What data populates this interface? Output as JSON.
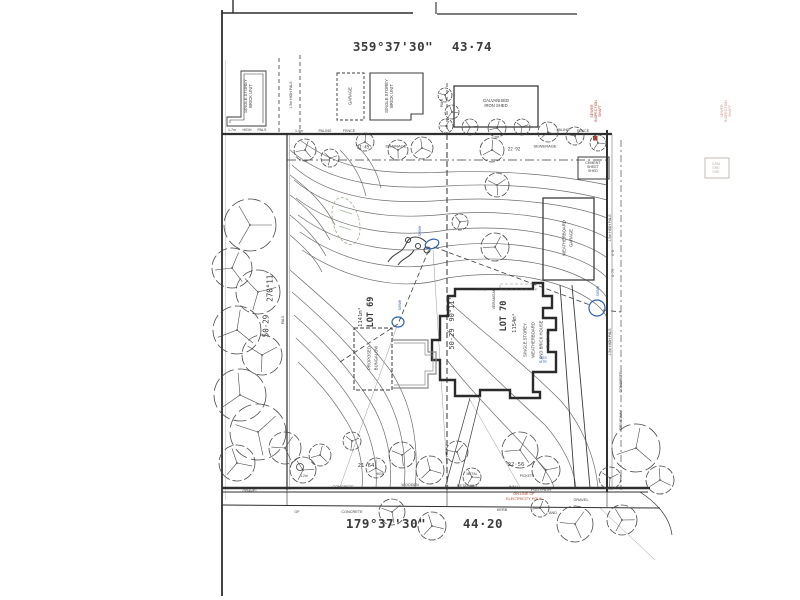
{
  "colors": {
    "ink": "#3b3b3b",
    "line": "#2f2f2f",
    "light": "#8a8a8a",
    "red": "#b2442e",
    "blue": "#2f62ae",
    "green": "#8aa87a",
    "fade": "#b9aca4",
    "fadeRed": "#d09a8c"
  },
  "summary": {
    "plan_type": "site survey plan",
    "lots": [
      {
        "label": "LOT 69",
        "area": "1141m²"
      },
      {
        "label": "LOT 70",
        "area": "1154m²"
      }
    ],
    "boundaries": {
      "north": {
        "bearing": "359°37'30\"",
        "distance": "43·74"
      },
      "south": {
        "bearing": "179°37'30\"",
        "distance": "44·20"
      },
      "west": {
        "bearing": "270°11'",
        "distance": "50·29"
      },
      "middle": {
        "bearing": "90°11'",
        "distance": "50·29"
      }
    },
    "street_strip": [
      "GRAVEL",
      "CONCRETE",
      "WOODEN",
      "RETAINING",
      "WALL",
      "FOOTPATH",
      "OF",
      "CONCRETE",
      "KERB",
      "AND",
      "GRAVEL"
    ]
  },
  "annotations": [
    {
      "name": "bearing-top",
      "text": "359°37'30\"",
      "x": 393,
      "y": 47,
      "rot": 0,
      "fs": 12.5,
      "mono": true,
      "bold": true,
      "ls": 0.5
    },
    {
      "name": "distance-top",
      "text": "43·74",
      "x": 472,
      "y": 47,
      "rot": 0,
      "fs": 12.5,
      "mono": true,
      "bold": true,
      "ls": 0.5
    },
    {
      "name": "bearing-bottom",
      "text": "179°37'30\"",
      "x": 386,
      "y": 524,
      "rot": 0,
      "fs": 12.5,
      "mono": true,
      "bold": true,
      "ls": 0.5
    },
    {
      "name": "distance-bottom",
      "text": "44·20",
      "x": 483,
      "y": 524,
      "rot": 0,
      "fs": 12.5,
      "mono": true,
      "bold": true,
      "ls": 0.5
    },
    {
      "name": "bearing-west",
      "text": "270°11'",
      "x": 271,
      "y": 286,
      "rot": -90,
      "fs": 7.5,
      "mono": true
    },
    {
      "name": "distance-west",
      "text": "50·29",
      "x": 267,
      "y": 326,
      "rot": -90,
      "fs": 7.5,
      "mono": true
    },
    {
      "name": "bearing-middle",
      "text": "90°11'",
      "x": 452,
      "y": 309,
      "rot": -90,
      "fs": 7,
      "mono": true
    },
    {
      "name": "distance-middle",
      "text": "50·29",
      "x": 452,
      "y": 339,
      "rot": -90,
      "fs": 7,
      "mono": true
    },
    {
      "name": "lot-69-label",
      "text": "LOT 69",
      "x": 372,
      "y": 312,
      "rot": -90,
      "fs": 8.5,
      "mono": true,
      "bold": true
    },
    {
      "name": "lot-69-area",
      "text": "1141m²",
      "x": 361,
      "y": 317,
      "rot": -90,
      "fs": 5.5,
      "mono": true
    },
    {
      "name": "lot-70-label",
      "text": "LOT 70",
      "x": 505,
      "y": 316,
      "rot": -90,
      "fs": 8.5,
      "mono": true,
      "bold": true
    },
    {
      "name": "lot-70-area",
      "text": "1154m²",
      "x": 515,
      "y": 323,
      "rot": -90,
      "fs": 5.5,
      "mono": true
    },
    {
      "name": "neighbour-unit-left",
      "text": "SINGLE STOREY\nBRICK UNIT",
      "x": 249,
      "y": 96,
      "rot": -90,
      "fs": 4.2
    },
    {
      "name": "neighbour-garage",
      "text": "GARAGE",
      "x": 351,
      "y": 96,
      "rot": -90,
      "fs": 4.2
    },
    {
      "name": "neighbour-unit-mid",
      "text": "SINGLE STOREY\nBRICK UNIT",
      "x": 390,
      "y": 96,
      "rot": -90,
      "fs": 4.2
    },
    {
      "name": "galvanised-iron-shed",
      "text": "GALVANISED\nIRON SHED",
      "x": 496,
      "y": 104,
      "rot": 0,
      "fs": 4.2
    },
    {
      "name": "cement-sheet-shed",
      "text": "CEMENT\nSHEET\nSHED",
      "x": 593,
      "y": 167,
      "rot": 0,
      "fs": 3.6
    },
    {
      "name": "cement-shed-ghost",
      "text": "CEM\nSHE\nSHE",
      "x": 716,
      "y": 168,
      "rot": 0,
      "fs": 3.6,
      "color": "fade"
    },
    {
      "name": "sewer-inspection-shaft",
      "text": "SEWER\nINSPECTION\nSHAFT",
      "x": 596,
      "y": 111,
      "rot": -90,
      "fs": 3.6,
      "color": "red"
    },
    {
      "name": "sewer-shaft-ghost",
      "text": "SEWER\nINSPECTION\nSHAFT",
      "x": 726,
      "y": 111,
      "rot": -90,
      "fs": 3.6,
      "color": "fadeRed"
    },
    {
      "name": "fence-label",
      "text": "1.7m",
      "x": 232,
      "y": 130,
      "rot": 0,
      "fs": 3.6
    },
    {
      "name": "fence-label",
      "text": "HIGH",
      "x": 247,
      "y": 130,
      "rot": 0,
      "fs": 3.6
    },
    {
      "name": "fence-label",
      "text": "PALS",
      "x": 262,
      "y": 130,
      "rot": 0,
      "fs": 3.6
    },
    {
      "name": "fence-label",
      "text": "1.4m",
      "x": 299,
      "y": 131,
      "rot": 0,
      "fs": 3.6
    },
    {
      "name": "fence-label",
      "text": "PALING",
      "x": 325,
      "y": 131,
      "rot": 0,
      "fs": 3.6
    },
    {
      "name": "fence-label",
      "text": "FENCE",
      "x": 349,
      "y": 131,
      "rot": 0,
      "fs": 3.6
    },
    {
      "name": "fence-label",
      "text": "PALING",
      "x": 563,
      "y": 130,
      "rot": 0,
      "fs": 3.6
    },
    {
      "name": "fence-label",
      "text": "FENCE",
      "x": 583,
      "y": 131,
      "rot": 0,
      "fs": 3.6
    },
    {
      "name": "fence-label",
      "text": "1.5m HIGH PALS",
      "x": 291,
      "y": 95,
      "rot": -90,
      "fs": 3.5
    },
    {
      "name": "fence-label",
      "text": "PALS",
      "x": 443,
      "y": 103,
      "rot": -90,
      "fs": 3.4
    },
    {
      "name": "fence-label",
      "text": "1.5m HIGH PALS",
      "x": 610,
      "y": 228,
      "rot": -90,
      "fs": 3.5
    },
    {
      "name": "fence-label",
      "text": "1.5m HIGH PALS",
      "x": 610,
      "y": 342,
      "rot": -90,
      "fs": 3.5
    },
    {
      "name": "spot-level",
      "text": "4·0",
      "x": 614,
      "y": 253,
      "rot": -90,
      "fs": 3.4,
      "mono": true
    },
    {
      "name": "spot-level",
      "text": "4·75",
      "x": 614,
      "y": 273,
      "rot": -90,
      "fs": 3.4,
      "mono": true
    },
    {
      "name": "surface-label-concrete",
      "text": "CONCRETE",
      "x": 621,
      "y": 382,
      "rot": -90,
      "fs": 3.8
    },
    {
      "name": "surface-label-driveway",
      "text": "DRIVEWAY",
      "x": 621,
      "y": 420,
      "rot": -90,
      "fs": 3.8
    },
    {
      "name": "easement-drainage",
      "text": "DRAINAGE",
      "x": 396,
      "y": 147,
      "rot": 0,
      "fs": 4
    },
    {
      "name": "easement-sewerage",
      "text": "SEWERAGE",
      "x": 545,
      "y": 147,
      "rot": 0,
      "fs": 4
    },
    {
      "name": "easement-dim-left",
      "text": "21·45",
      "x": 363,
      "y": 148,
      "rot": 0,
      "fs": 4.2,
      "mono": true
    },
    {
      "name": "easement-dim-right",
      "text": "22·92",
      "x": 514,
      "y": 150,
      "rot": 0,
      "fs": 4.2,
      "mono": true
    },
    {
      "name": "patio-label",
      "text": "PATIO",
      "x": 481,
      "y": 290,
      "rot": 0,
      "fs": 4
    },
    {
      "name": "verandah-label",
      "text": "VERANDAH",
      "x": 494,
      "y": 299,
      "rot": -90,
      "fs": 3.8
    },
    {
      "name": "house-label",
      "text": "SINGLE STOREY\nWEATHERBOARD\nAND BRICK HOUSE\nFL 17·42",
      "x": 537,
      "y": 340,
      "rot": -90,
      "fs": 4.2,
      "lh": 1.85
    },
    {
      "name": "weatherboard-garage",
      "text": "WEATHERBOARD\nGARAGE",
      "x": 568,
      "y": 238,
      "rot": -90,
      "fs": 4.2,
      "lh": 1.6
    },
    {
      "name": "proposed-bungalow",
      "text": "PROPOSED\nBUNGALOW",
      "x": 373,
      "y": 358,
      "rot": -90,
      "fs": 4.2,
      "lh": 1.6
    },
    {
      "name": "sewer-manhole-label",
      "text": "SWMH",
      "x": 421,
      "y": 231,
      "rot": -90,
      "fs": 3.4,
      "color": "blue"
    },
    {
      "name": "sewer-manhole-label",
      "text": "SWMH",
      "x": 401,
      "y": 305,
      "rot": -90,
      "fs": 3.4,
      "color": "blue"
    },
    {
      "name": "sewer-manhole-label",
      "text": "SWMH",
      "x": 599,
      "y": 291,
      "rot": -90,
      "fs": 3.4,
      "color": "blue"
    },
    {
      "name": "gas-meter-label",
      "text": "GAS\nMTR",
      "x": 543,
      "y": 361,
      "rot": 0,
      "fs": 3.4,
      "color": "blue"
    },
    {
      "name": "electricity-pole-note",
      "text": "ON LINE OF\nELECTRICITY POLE",
      "x": 524,
      "y": 497,
      "rot": 0,
      "fs": 3.8,
      "color": "red",
      "lh": 1.3
    },
    {
      "name": "frontage-dim-left",
      "text": "21·64",
      "x": 366,
      "y": 466,
      "rot": 0,
      "fs": 5.5,
      "mono": true
    },
    {
      "name": "frontage-dim-right",
      "text": "22·56",
      "x": 516,
      "y": 465,
      "rot": 0,
      "fs": 5.5,
      "mono": true
    },
    {
      "name": "fence-label",
      "text": "1.2m",
      "x": 304,
      "y": 477,
      "rot": 0,
      "fs": 3.4
    },
    {
      "name": "fence-label",
      "text": "HIGH",
      "x": 380,
      "y": 475,
      "rot": 0,
      "fs": 3.4
    },
    {
      "name": "fence-label",
      "text": "METAL",
      "x": 472,
      "y": 475,
      "rot": 0,
      "fs": 3.4
    },
    {
      "name": "fence-label",
      "text": "PICKETS",
      "x": 527,
      "y": 477,
      "rot": 0,
      "fs": 3.4
    },
    {
      "name": "street-strip-label",
      "text": "GRAVEL",
      "x": 250,
      "y": 491,
      "rot": 0,
      "fs": 3.8
    },
    {
      "name": "street-strip-label",
      "text": "CONCRETE",
      "x": 343,
      "y": 487,
      "rot": 0,
      "fs": 3.8
    },
    {
      "name": "street-strip-label",
      "text": "WOODEN",
      "x": 410,
      "y": 485,
      "rot": 0,
      "fs": 3.8
    },
    {
      "name": "street-strip-label",
      "text": "RETAINING",
      "x": 467,
      "y": 486,
      "rot": 0,
      "fs": 3.8
    },
    {
      "name": "street-strip-label",
      "text": "WALL",
      "x": 514,
      "y": 487,
      "rot": 0,
      "fs": 3.8
    },
    {
      "name": "street-strip-label",
      "text": "FOOTPATH",
      "x": 541,
      "y": 490,
      "rot": 0,
      "fs": 3.8
    },
    {
      "name": "street-strip-label",
      "text": "GRAVEL",
      "x": 581,
      "y": 500,
      "rot": 0,
      "fs": 3.8
    },
    {
      "name": "street-strip-label",
      "text": "OF",
      "x": 297,
      "y": 512,
      "rot": 0,
      "fs": 3.8
    },
    {
      "name": "street-strip-label",
      "text": "CONCRETE",
      "x": 352,
      "y": 512,
      "rot": 0,
      "fs": 3.8
    },
    {
      "name": "street-strip-label",
      "text": "KERB",
      "x": 502,
      "y": 510,
      "rot": 0,
      "fs": 3.8
    },
    {
      "name": "street-strip-label",
      "text": "AND",
      "x": 553,
      "y": 513,
      "rot": 0,
      "fs": 3.8
    },
    {
      "name": "fence-label",
      "text": "PALS",
      "x": 284,
      "y": 320,
      "rot": -90,
      "fs": 3.4
    }
  ],
  "trees": [
    [
      250,
      225,
      26
    ],
    [
      232,
      268,
      20
    ],
    [
      258,
      292,
      22
    ],
    [
      237,
      330,
      24
    ],
    [
      262,
      355,
      20
    ],
    [
      240,
      395,
      26
    ],
    [
      258,
      432,
      28
    ],
    [
      237,
      463,
      18
    ],
    [
      285,
      448,
      16
    ],
    [
      303,
      470,
      13
    ],
    [
      305,
      150,
      11
    ],
    [
      330,
      158,
      9
    ],
    [
      365,
      142,
      9
    ],
    [
      398,
      150,
      10
    ],
    [
      422,
      148,
      11
    ],
    [
      445,
      95,
      7
    ],
    [
      452,
      112,
      7
    ],
    [
      446,
      126,
      7
    ],
    [
      470,
      127,
      8
    ],
    [
      497,
      128,
      9
    ],
    [
      522,
      127,
      8
    ],
    [
      492,
      150,
      12
    ],
    [
      497,
      185,
      12
    ],
    [
      548,
      132,
      10
    ],
    [
      575,
      136,
      9
    ],
    [
      598,
      143,
      8
    ],
    [
      495,
      247,
      14
    ],
    [
      460,
      222,
      8
    ],
    [
      320,
      455,
      11
    ],
    [
      352,
      441,
      9
    ],
    [
      376,
      468,
      10
    ],
    [
      402,
      455,
      13
    ],
    [
      430,
      470,
      14
    ],
    [
      457,
      452,
      11
    ],
    [
      472,
      477,
      9
    ],
    [
      520,
      450,
      18
    ],
    [
      546,
      470,
      14
    ],
    [
      636,
      448,
      24
    ],
    [
      610,
      478,
      11
    ],
    [
      660,
      480,
      14
    ],
    [
      392,
      512,
      13
    ],
    [
      432,
      526,
      14
    ],
    [
      575,
      524,
      18
    ],
    [
      622,
      520,
      15
    ],
    [
      540,
      508,
      9
    ]
  ]
}
